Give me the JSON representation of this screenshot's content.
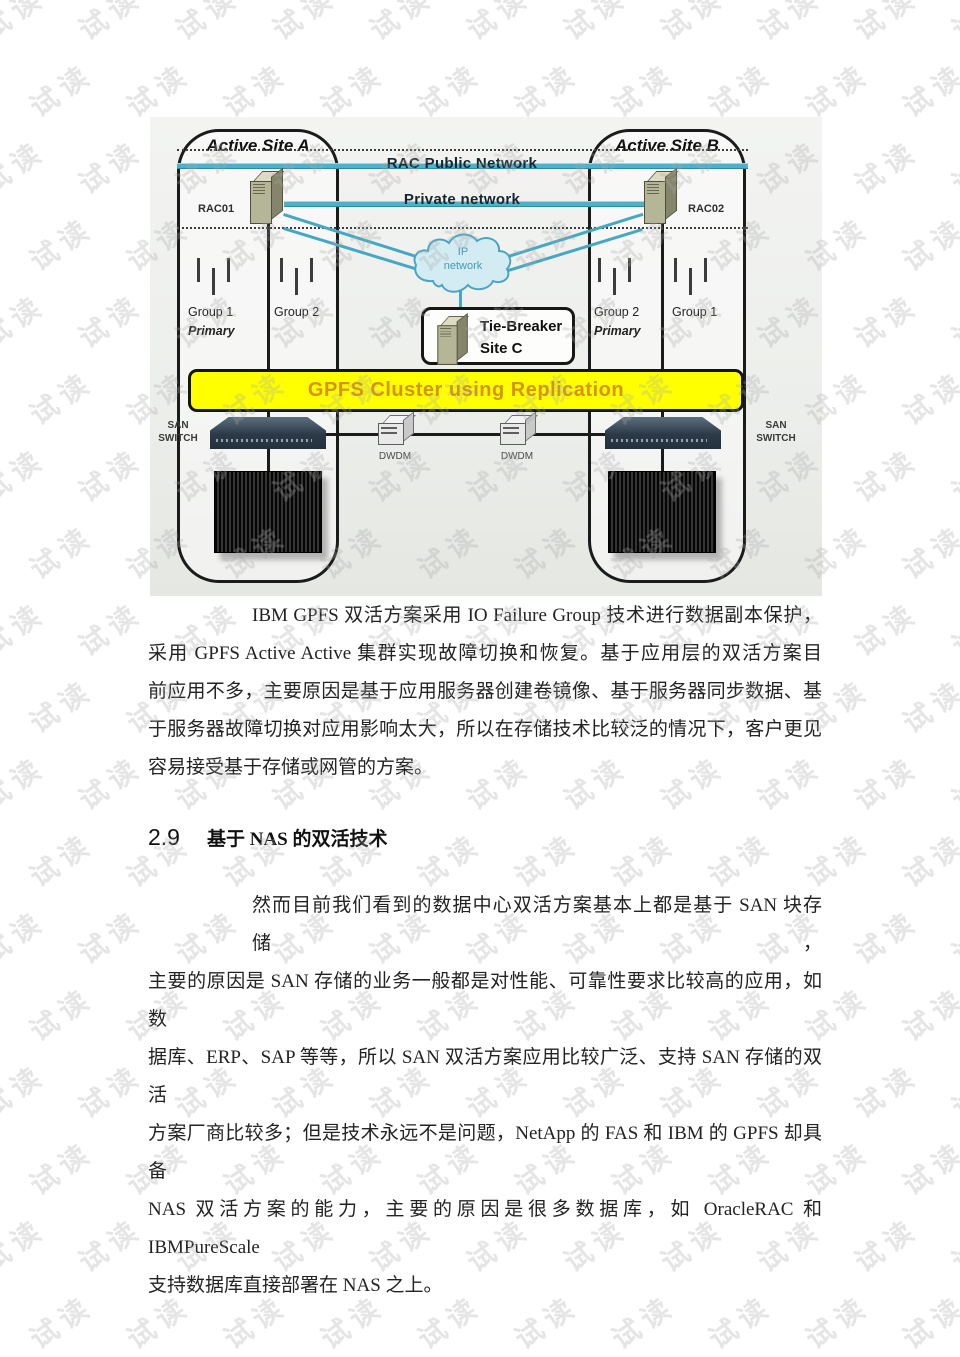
{
  "watermark": {
    "text": "试读"
  },
  "colors": {
    "banner_bg": "#ffff00",
    "banner_text": "#d6930b",
    "network_line": "#4fb0c9",
    "cloud_fill": "#d3ecf4",
    "cloud_stroke": "#4aa6c0",
    "diagram_bg": "#edeeec"
  },
  "diagram": {
    "site_a": {
      "title": "Active Site A",
      "rac_label": "RAC01",
      "groups": [
        {
          "name": "Group 1",
          "tag": "Primary"
        },
        {
          "name": "Group 2",
          "tag": ""
        }
      ]
    },
    "site_b": {
      "title": "Active Site B",
      "rac_label": "RAC02",
      "groups": [
        {
          "name": "Group 2",
          "tag": "Primary"
        },
        {
          "name": "Group 1",
          "tag": ""
        }
      ]
    },
    "public_network_label": "RAC Public Network",
    "private_network_label": "Private network",
    "cloud_label": "IP\nnetwork",
    "tie_breaker_label": "Tie-Breaker\nSite C",
    "banner_label": "GPFS Cluster using Replication",
    "san_switch_label": "SAN\nSWITCH",
    "dwdm_label": "DWDM"
  },
  "section": {
    "number": "2.9",
    "title": "基于 NAS 的双活技术"
  },
  "paragraph1": {
    "lines": [
      "IBM GPFS 双活方案采用 IO Failure Group 技术进行数据副本保护，",
      "采用 GPFS Active Active 集群实现故障切换和恢复。基于应用层的双活方案目",
      "前应用不多，主要原因是基于应用服务器创建卷镜像、基于服务器同步数据、基",
      "于服务器故障切换对应用影响太大，所以在存储技术比较泛的情况下，客户更见",
      "容易接受基于存储或网管的方案。"
    ]
  },
  "paragraph2": {
    "lines": [
      "然而目前我们看到的数据中心双活方案基本上都是基于 SAN 块存储，",
      "主要的原因是 SAN 存储的业务一般都是对性能、可靠性要求比较高的应用，如数",
      "据库、ERP、SAP 等等，所以 SAN 双活方案应用比较广泛、支持 SAN 存储的双活",
      "方案厂商比较多；但是技术永远不是问题，NetApp 的 FAS 和 IBM 的 GPFS 却具备",
      "NAS 双活方案的能力，主要的原因是很多数据库，如 OracleRAC 和 IBMPureScale",
      "支持数据库直接部署在 NAS 之上。"
    ]
  }
}
